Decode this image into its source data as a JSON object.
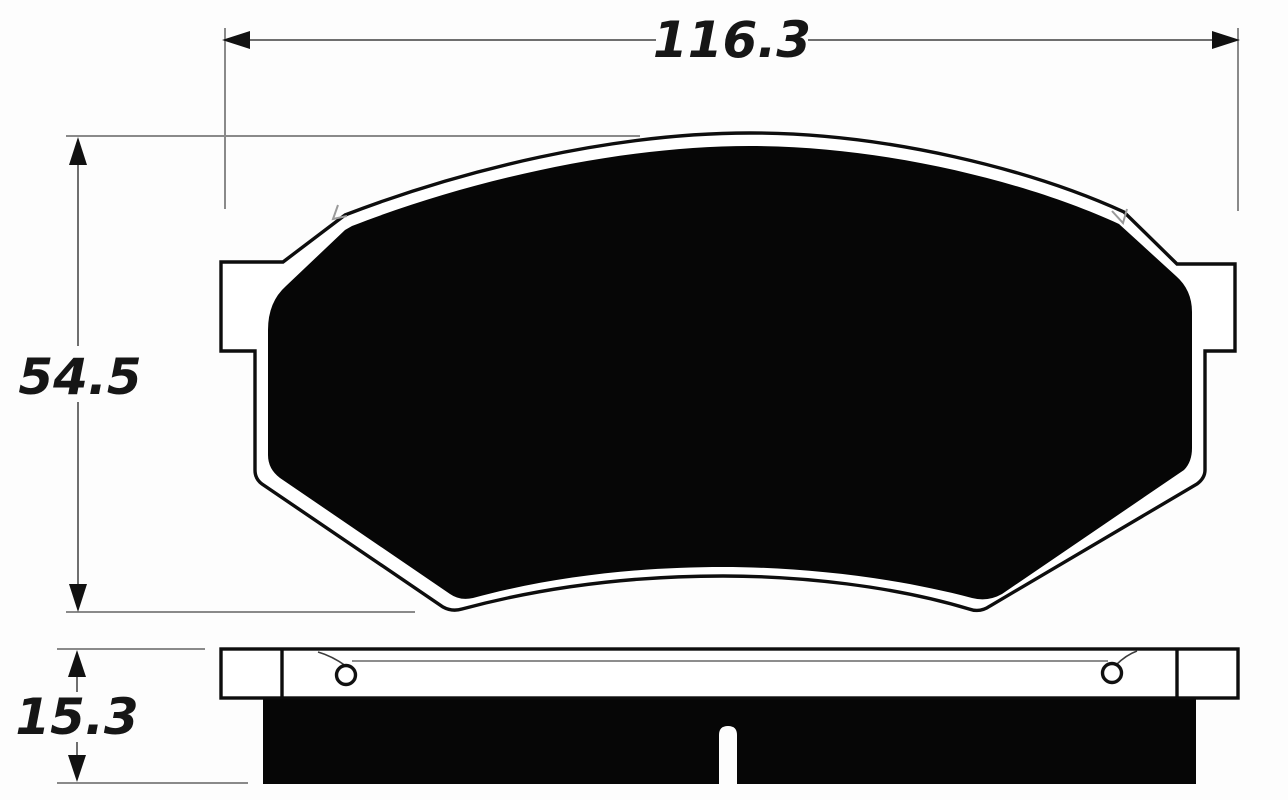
{
  "drawing": {
    "dimensions": {
      "width": "116.3",
      "height": "54.5",
      "thickness": "15.3"
    },
    "colors": {
      "background": "#fdfdfd",
      "ink": "#0d0d0d",
      "pad_fill": "#060606",
      "dimension_line": "#6f6f6f",
      "extension_line": "#8a8a8a",
      "label_text": "#161616"
    }
  }
}
